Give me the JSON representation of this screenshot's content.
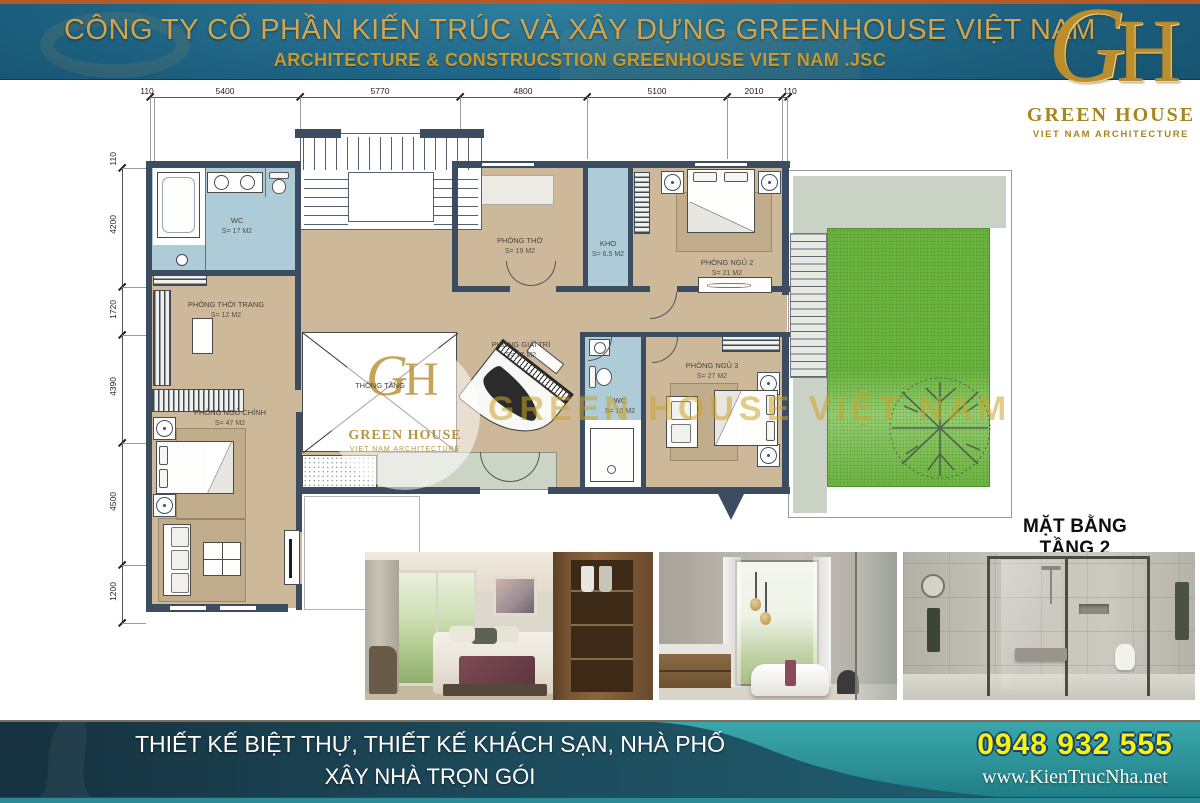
{
  "header": {
    "title": "CÔNG TY CỔ PHẦN KIẾN TRÚC VÀ XÂY DỰNG GREENHOUSE VIỆT NAM",
    "subtitle": "ARCHITECTURE & CONSTRUCSTION GREENHOUSE VIET NAM .JSC"
  },
  "logo": {
    "monogram_g": "G",
    "monogram_h": "H",
    "name": "GREEN HOUSE",
    "tagline": "VIET NAM ARCHITECTURE"
  },
  "plan": {
    "title": "MẶT BẰNG TẦNG 2",
    "dimensions_top": [
      "110",
      "5400",
      "5770",
      "4800",
      "5100",
      "2010",
      "110"
    ],
    "dimensions_left": [
      "110",
      "4200",
      "1720",
      "4390",
      "4500",
      "1200"
    ],
    "rooms": {
      "wc_17": {
        "name": "WC",
        "area": "S= 17 M2"
      },
      "thoi_trang": {
        "name": "PHÒNG THỜI TRANG",
        "area": "S= 12 M2"
      },
      "ngu_chinh": {
        "name": "PHÒNG NGỦ CHÍNH",
        "area": "S= 47 M2"
      },
      "tho": {
        "name": "PHÒNG THỜ",
        "area": "S= 19 M2"
      },
      "kho": {
        "name": "KHO",
        "area": "S= 6.5 M2"
      },
      "ngu_2": {
        "name": "PHÒNG NGỦ 2",
        "area": "S= 21 M2"
      },
      "giai_tri": {
        "name": "PHÒNG GIẢI TRÍ",
        "area": "S= 27 M2"
      },
      "thong_tang": {
        "name": "THÔNG TẦNG"
      },
      "wc_10": {
        "name": "WC",
        "area": "S= 10 M2"
      },
      "ngu_3": {
        "name": "PHÒNG NGỦ 3",
        "area": "S= 27 M2"
      }
    },
    "watermark": {
      "text": "GREEN HOUSE VIỆT NAM",
      "logo_name": "GREEN HOUSE",
      "logo_tagline": "VIET NAM ARCHITECTURE"
    }
  },
  "photos": [
    {
      "subject": "bedroom interior"
    },
    {
      "subject": "bathroom with bathtub"
    },
    {
      "subject": "walk-in shower room"
    }
  ],
  "footer": {
    "services_line1": "THIẾT KẾ BIỆT THỰ, THIẾT KẾ KHÁCH SẠN, NHÀ PHỐ",
    "services_line2": "XÂY NHÀ TRỌN GÓI",
    "phone": "0948 932 555",
    "website": "www.KienTrucNha.net"
  },
  "colors": {
    "gold": "#d2a44c",
    "header_teal": "#1d6080",
    "top_strip_orange": "#b45a28",
    "wall": "#3c4d61",
    "floor_tan": "#cdb99a",
    "wet_area_blue": "#aecbd8",
    "lawn_green": "#6ab23e",
    "footer_teal": "#2f9fa2",
    "phone_yellow": "#f5f411"
  }
}
